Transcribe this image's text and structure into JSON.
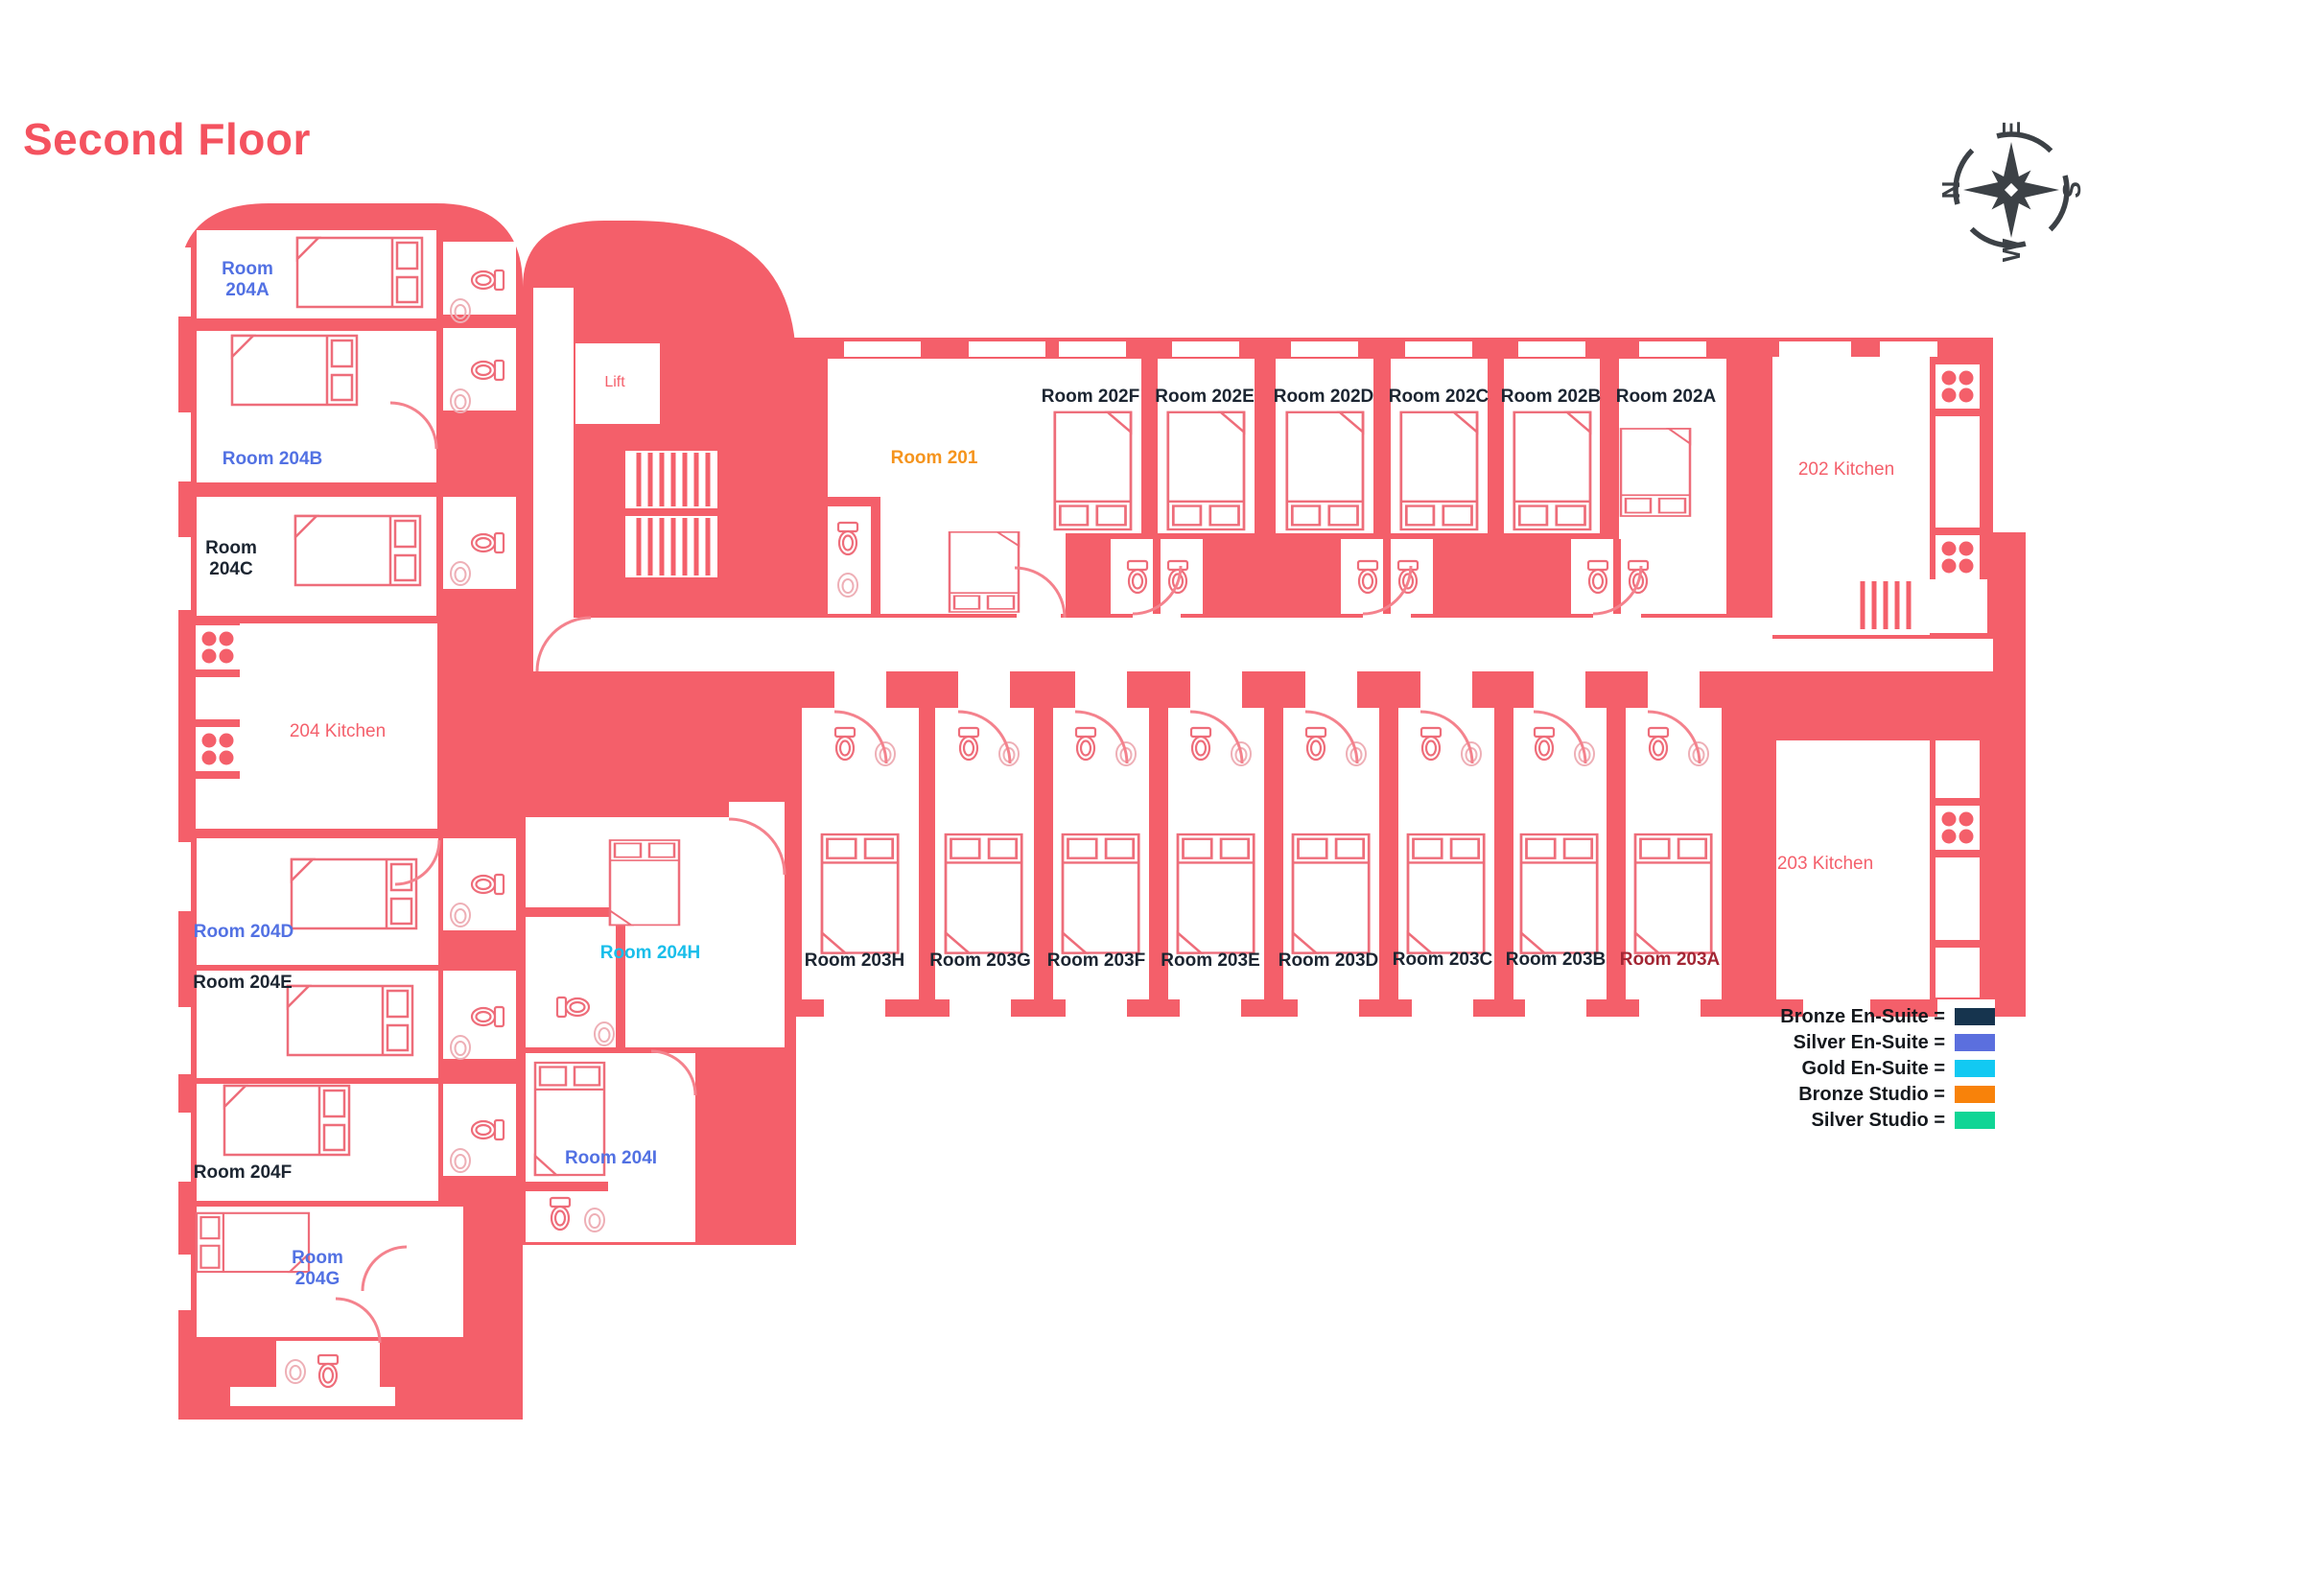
{
  "title": "Second Floor",
  "palette": {
    "plan": "#F45F6A",
    "title": "#F4525F",
    "compass": "#3C4146",
    "plan_label": "#F4606C",
    "black_label": "#1C2531",
    "blue_label": "#5271E3",
    "cyan_label": "#19BEEA",
    "orange_label": "#F5941D",
    "dark_red_label": "#A32634"
  },
  "compass": {
    "north": "N",
    "east": "E",
    "south": "S",
    "west": "W"
  },
  "legend": {
    "items": [
      {
        "label": "Bronze En-Suite =",
        "color": "#16344E"
      },
      {
        "label": "Silver En-Suite =",
        "color": "#5B6FDE"
      },
      {
        "label": "Gold En-Suite =",
        "color": "#12C9F2"
      },
      {
        "label": "Bronze Studio =",
        "color": "#F8820A"
      },
      {
        "label": "Silver Studio =",
        "color": "#10D595"
      }
    ]
  },
  "areas": {
    "lift": "Lift",
    "kitchen_202": "202 Kitchen",
    "kitchen_203": "203 Kitchen",
    "kitchen_204": "204 Kitchen"
  },
  "rooms": [
    {
      "id": "204A",
      "label": "Room\n204A",
      "color": "#5271E3"
    },
    {
      "id": "204B",
      "label": "Room 204B",
      "color": "#5271E3"
    },
    {
      "id": "204C",
      "label": "Room\n204C",
      "color": "#1C2531"
    },
    {
      "id": "204D",
      "label": "Room 204D",
      "color": "#5271E3"
    },
    {
      "id": "204E",
      "label": "Room 204E",
      "color": "#1C2531"
    },
    {
      "id": "204F",
      "label": "Room 204F",
      "color": "#1C2531"
    },
    {
      "id": "204G",
      "label": "Room\n204G",
      "color": "#5271E3"
    },
    {
      "id": "204H",
      "label": "Room 204H",
      "color": "#19BEEA"
    },
    {
      "id": "204I",
      "label": "Room 204I",
      "color": "#5271E3"
    },
    {
      "id": "201",
      "label": "Room 201",
      "color": "#F5941D"
    },
    {
      "id": "202F",
      "label": "Room 202F",
      "color": "#1C2531"
    },
    {
      "id": "202E",
      "label": "Room 202E",
      "color": "#1C2531"
    },
    {
      "id": "202D",
      "label": "Room 202D",
      "color": "#1C2531"
    },
    {
      "id": "202C",
      "label": "Room 202C",
      "color": "#1C2531"
    },
    {
      "id": "202B",
      "label": "Room 202B",
      "color": "#1C2531"
    },
    {
      "id": "202A",
      "label": "Room 202A",
      "color": "#1C2531"
    },
    {
      "id": "203H",
      "label": "Room 203H",
      "color": "#1C2531"
    },
    {
      "id": "203G",
      "label": "Room 203G",
      "color": "#1C2531"
    },
    {
      "id": "203F",
      "label": "Room 203F",
      "color": "#1C2531"
    },
    {
      "id": "203E",
      "label": "Room 203E",
      "color": "#1C2531"
    },
    {
      "id": "203D",
      "label": "Room 203D",
      "color": "#1C2531"
    },
    {
      "id": "203C",
      "label": "Room 203C",
      "color": "#1C2531"
    },
    {
      "id": "203B",
      "label": "Room 203B",
      "color": "#1C2531"
    },
    {
      "id": "203A",
      "label": "Room 203A",
      "color": "#A32634"
    }
  ]
}
